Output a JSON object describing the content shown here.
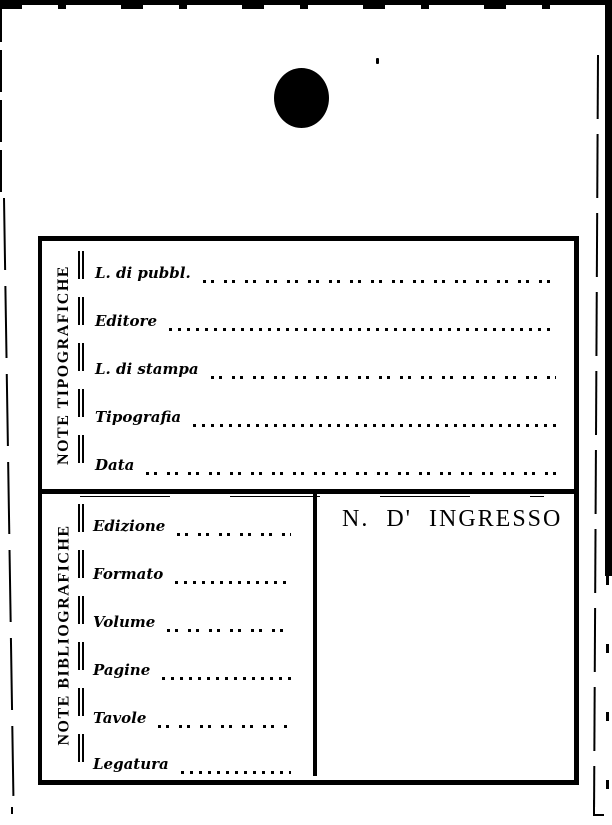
{
  "page": {
    "paper_color": "#ffffff",
    "ink_color": "#000000"
  },
  "card": {
    "sections": [
      {
        "side_label": "NOTE TIPOGRAFICHE",
        "fields": [
          {
            "label": "L. di pubbl."
          },
          {
            "label": "Editore"
          },
          {
            "label": "L. di stampa"
          },
          {
            "label": "Tipografia"
          },
          {
            "label": "Data"
          }
        ]
      },
      {
        "side_label": "NOTE BIBLIOGRAFICHE",
        "fields": [
          {
            "label": "Edizione"
          },
          {
            "label": "Formato"
          },
          {
            "label": "Volume"
          },
          {
            "label": "Pagine"
          },
          {
            "label": "Tavole"
          },
          {
            "label": "Legatura"
          }
        ],
        "ingresso_title": "N. D' INGRESSO"
      }
    ]
  }
}
